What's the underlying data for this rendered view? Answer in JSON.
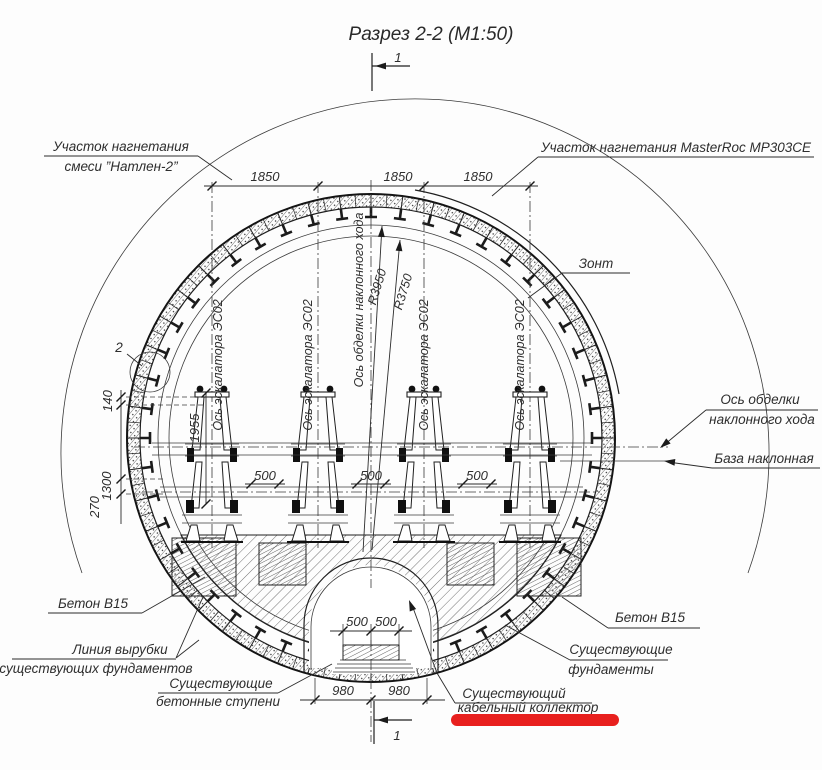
{
  "title": "Разрез 2-2 (М1:50)",
  "markers": {
    "section_top": "1",
    "section_bottom": "1",
    "detail": "2"
  },
  "labels": {
    "grout_left_line1": "Участок нагнетания",
    "grout_left_line2": "смеси ”Натлен-2”",
    "grout_right": "Участок нагнетания MasterRoc MP303CE",
    "umbrella": "Зонт",
    "escalator_axis": "Ось эскалатора ЭС02",
    "incline_axis_vertical": "Ось обделки наклонного хода",
    "radius_outer": "R3950",
    "radius_inner": "R3750",
    "incline_axis_line1": "Ось обделки",
    "incline_axis_line2": "наклонного хода",
    "incline_base": "База наклонная",
    "concrete_left": "Бетон В15",
    "concrete_right": "Бетон В15",
    "cut_line_line1": "Линия вырубки",
    "cut_line_line2": "существующих фундаментов",
    "steps_line1": "Существующие",
    "steps_line2": "бетонные ступени",
    "foundations_line1": "Существующие",
    "foundations_line2": "фундаменты",
    "collector_line1": "Существующий",
    "collector_line2": "кабельный коллектор"
  },
  "dimensions": {
    "top": [
      "1850",
      "1850",
      "1850"
    ],
    "left_140": "140",
    "left_1300": "1300",
    "left_270": "270",
    "left_1955": "1955",
    "gap_500": [
      "500",
      "500",
      "500"
    ],
    "collector_500": [
      "500",
      "500"
    ],
    "bottom_980": [
      "980",
      "980"
    ]
  },
  "colors": {
    "highlight_red": "#e8201e",
    "ink": "#1f1f1f"
  }
}
